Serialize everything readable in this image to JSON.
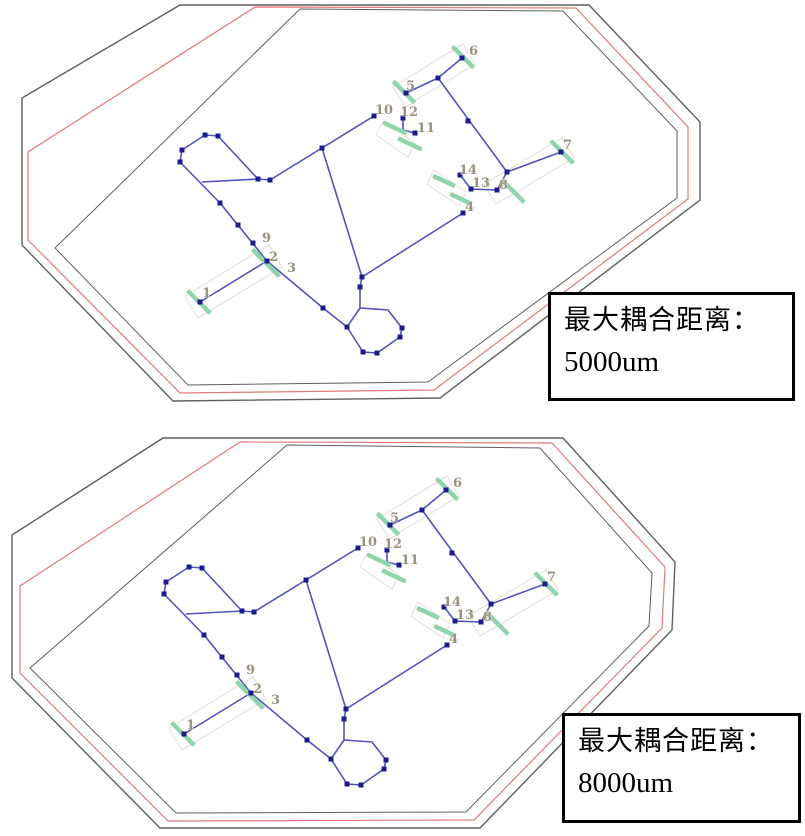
{
  "colors": {
    "outline": "#5f5f5f",
    "red": "#e07a7a",
    "wire": "#5353bd",
    "vertex": "#1b1b8e",
    "pad": "#8fd4ac",
    "band": "#e3dcdc",
    "label": "#98927e",
    "box_border": "#000000",
    "box_text": "#000000",
    "background": "#ffffff"
  },
  "diagrams": [
    {
      "id": "top",
      "net_offset": {
        "dx": 0,
        "dy": 0
      },
      "outlines": {
        "outer": [
          [
            180,
            5
          ],
          [
            589,
            5
          ],
          [
            700,
            122
          ],
          [
            700,
            200
          ],
          [
            440,
            398
          ],
          [
            173,
            401
          ],
          [
            22,
            245
          ],
          [
            22,
            98
          ]
        ],
        "red": [
          [
            255,
            7
          ],
          [
            576,
            8
          ],
          [
            688,
            127
          ],
          [
            688,
            199
          ],
          [
            434,
            390
          ],
          [
            180,
            393
          ],
          [
            28,
            240
          ],
          [
            28,
            152
          ]
        ],
        "inner": [
          [
            300,
            9
          ],
          [
            563,
            11
          ],
          [
            677,
            131
          ],
          [
            677,
            198
          ],
          [
            428,
            382
          ],
          [
            188,
            385
          ],
          [
            55,
            248
          ]
        ]
      },
      "box": {
        "line1": "最大耦合距离：",
        "line2": "5000um"
      }
    },
    {
      "id": "bottom",
      "net_offset": {
        "dx": -16,
        "dy": 432
      },
      "outlines": {
        "outer": [
          [
            163,
            438
          ],
          [
            563,
            438
          ],
          [
            675,
            562
          ],
          [
            672,
            630
          ],
          [
            480,
            828
          ],
          [
            160,
            828
          ],
          [
            12,
            678
          ],
          [
            12,
            535
          ]
        ],
        "red": [
          [
            240,
            442
          ],
          [
            552,
            443
          ],
          [
            665,
            567
          ],
          [
            662,
            628
          ],
          [
            474,
            820
          ],
          [
            168,
            821
          ],
          [
            20,
            673
          ],
          [
            20,
            586
          ]
        ],
        "inner": [
          [
            287,
            445
          ],
          [
            540,
            448
          ],
          [
            652,
            573
          ],
          [
            649,
            626
          ],
          [
            466,
            812
          ],
          [
            176,
            813
          ],
          [
            30,
            668
          ]
        ]
      },
      "box": {
        "line1": "最大耦合距离：",
        "line2": "8000um"
      }
    }
  ],
  "network": {
    "wires": [
      [
        [
          200,
          302
        ],
        [
          267,
          261
        ]
      ],
      [
        [
          267,
          261
        ],
        [
          323,
          308
        ]
      ],
      [
        [
          323,
          308
        ],
        [
          347,
          327
        ]
      ],
      [
        [
          347,
          327
        ],
        [
          360,
          308
        ]
      ],
      [
        [
          360,
          308
        ],
        [
          360,
          287
        ],
        [
          362,
          277
        ]
      ],
      [
        [
          362,
          277
        ],
        [
          463,
          213
        ]
      ],
      [
        [
          322,
          148
        ],
        [
          362,
          277
        ]
      ],
      [
        [
          374,
          116
        ],
        [
          270,
          180
        ]
      ],
      [
        [
          270,
          180
        ],
        [
          258,
          179
        ]
      ],
      [
        [
          258,
          179
        ],
        [
          218,
          136
        ],
        [
          205,
          135
        ],
        [
          182,
          150
        ],
        [
          180,
          162
        ],
        [
          220,
          203
        ]
      ],
      [
        [
          202,
          182
        ],
        [
          258,
          179
        ]
      ],
      [
        [
          220,
          203
        ],
        [
          267,
          261
        ]
      ],
      [
        [
          360,
          308
        ],
        [
          388,
          310
        ],
        [
          402,
          328
        ],
        [
          400,
          337
        ],
        [
          377,
          353
        ],
        [
          363,
          352
        ],
        [
          347,
          327
        ]
      ],
      [
        [
          462,
          58
        ],
        [
          438,
          78
        ],
        [
          406,
          93
        ]
      ],
      [
        [
          438,
          78
        ],
        [
          507,
          172
        ]
      ],
      [
        [
          507,
          172
        ],
        [
          561,
          152
        ]
      ],
      [
        [
          507,
          172
        ],
        [
          497,
          190
        ]
      ],
      [
        [
          497,
          190
        ],
        [
          471,
          189
        ]
      ],
      [
        [
          471,
          189
        ],
        [
          460,
          175
        ]
      ],
      [
        [
          403,
          118
        ],
        [
          403,
          130
        ],
        [
          415,
          133
        ]
      ]
    ],
    "squares": [
      [
        205,
        135
      ],
      [
        218,
        136
      ],
      [
        182,
        150
      ],
      [
        180,
        162
      ],
      [
        220,
        203
      ],
      [
        238,
        225
      ],
      [
        253,
        243
      ],
      [
        258,
        179
      ],
      [
        270,
        180
      ],
      [
        322,
        148
      ],
      [
        374,
        116
      ],
      [
        403,
        118
      ],
      [
        415,
        133
      ],
      [
        200,
        302
      ],
      [
        267,
        261
      ],
      [
        362,
        277
      ],
      [
        360,
        287
      ],
      [
        323,
        308
      ],
      [
        347,
        327
      ],
      [
        402,
        328
      ],
      [
        400,
        337
      ],
      [
        377,
        353
      ],
      [
        363,
        352
      ],
      [
        406,
        93
      ],
      [
        462,
        58
      ],
      [
        438,
        78
      ],
      [
        468,
        121
      ],
      [
        507,
        172
      ],
      [
        561,
        152
      ],
      [
        497,
        190
      ],
      [
        471,
        189
      ],
      [
        460,
        175
      ],
      [
        463,
        213
      ]
    ],
    "pads": [
      {
        "x": 199,
        "y": 302,
        "a": 45,
        "len": 32
      },
      {
        "x": 266,
        "y": 263,
        "a": 45,
        "len": 38
      },
      {
        "x": 404,
        "y": 92,
        "a": 45,
        "len": 30
      },
      {
        "x": 463,
        "y": 57,
        "a": 45,
        "len": 30
      },
      {
        "x": 562,
        "y": 152,
        "a": 45,
        "len": 32
      },
      {
        "x": 513,
        "y": 191,
        "a": 45,
        "len": 32
      },
      {
        "x": 395,
        "y": 128,
        "a": 25,
        "len": 26
      },
      {
        "x": 410,
        "y": 144,
        "a": 25,
        "len": 26
      },
      {
        "x": 444,
        "y": 181,
        "a": 25,
        "len": 24
      },
      {
        "x": 461,
        "y": 199,
        "a": 25,
        "len": 24
      }
    ],
    "bands": [
      [
        [
          185,
          296
        ],
        [
          269,
          245
        ],
        [
          282,
          267
        ],
        [
          198,
          318
        ]
      ],
      [
        [
          393,
          87
        ],
        [
          463,
          44
        ],
        [
          475,
          64
        ],
        [
          405,
          107
        ]
      ],
      [
        [
          484,
          184
        ],
        [
          562,
          138
        ],
        [
          574,
          158
        ],
        [
          496,
          204
        ]
      ],
      [
        [
          434,
          170
        ],
        [
          466,
          192
        ],
        [
          459,
          206
        ],
        [
          427,
          184
        ]
      ],
      [
        [
          383,
          121
        ],
        [
          415,
          143
        ],
        [
          408,
          157
        ],
        [
          376,
          135
        ]
      ]
    ],
    "labels": [
      {
        "t": "1",
        "x": 202,
        "y": 297
      },
      {
        "t": "2",
        "x": 269,
        "y": 261
      },
      {
        "t": "3",
        "x": 287,
        "y": 272
      },
      {
        "t": "4",
        "x": 465,
        "y": 211
      },
      {
        "t": "5",
        "x": 406,
        "y": 90
      },
      {
        "t": "6",
        "x": 469,
        "y": 55
      },
      {
        "t": "7",
        "x": 563,
        "y": 149
      },
      {
        "t": "8",
        "x": 499,
        "y": 189
      },
      {
        "t": "9",
        "x": 262,
        "y": 242
      },
      {
        "t": "10",
        "x": 375,
        "y": 114
      },
      {
        "t": "11",
        "x": 417,
        "y": 132
      },
      {
        "t": "12",
        "x": 400,
        "y": 116
      },
      {
        "t": "13",
        "x": 472,
        "y": 187
      },
      {
        "t": "14",
        "x": 459,
        "y": 174
      }
    ]
  }
}
